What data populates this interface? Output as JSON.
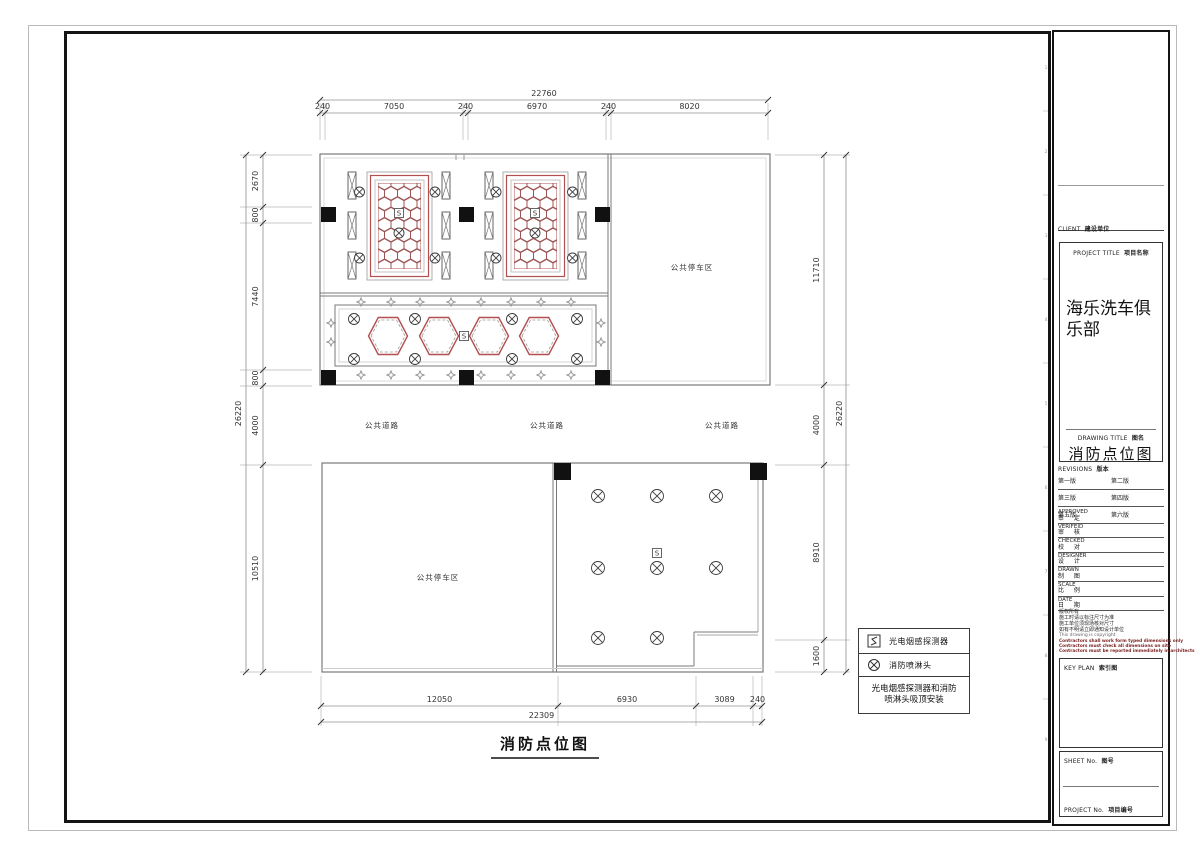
{
  "colors": {
    "wall": "#7a7a7a",
    "red": "#b24f4f",
    "comb": "#9c5454",
    "dimline": "#909090",
    "dimtext": "#333333",
    "ext": "#b8b8b8",
    "column": "#111111",
    "symbol": "#3c3c3c"
  },
  "title_block": {
    "client_label": "CLIENT",
    "client_value": "建设单位",
    "project_title_label": "PROJECT TITLE",
    "project_title_value": "项目名称",
    "project_name": "海乐洗车俱乐部",
    "drawing_title_label": "DRAWING TITLE",
    "drawing_title_value": "图名",
    "drawing_name": "消防点位图",
    "revisions_label": "REVISIONS",
    "revisions_value": "版本",
    "revisions": [
      [
        "第一版",
        "第二版"
      ],
      [
        "第三版",
        "第四版"
      ],
      [
        "第五版",
        "第六版"
      ]
    ],
    "fields": [
      {
        "en": "APPROVED",
        "cn": "审 定"
      },
      {
        "en": "VERIFEID",
        "cn": "审 核"
      },
      {
        "en": "CHECKED",
        "cn": "校 对"
      },
      {
        "en": "DESIGNER",
        "cn": "设 计"
      },
      {
        "en": "DRAWN",
        "cn": "制 图"
      },
      {
        "en": "SCALE",
        "cn": "比 例"
      },
      {
        "en": "DATE",
        "cn": "日 期"
      }
    ],
    "notes_cn": [
      "版权所有",
      "施工时请以标注尺寸为准",
      "施工单位须现场核对尺寸",
      "如有不明请立即通知设计单位"
    ],
    "note_en": "This drawing is copyright",
    "notes_warning": [
      "Contractors shall work form typed dimensions only",
      "Contractors must check all dimensions on site",
      "Contractors must be reported immediately in architects"
    ],
    "key_plan_label": "KEY PLAN",
    "key_plan_value": "索引图",
    "sheet_label": "SHEET No.",
    "sheet_value": "图号",
    "project_no_label": "PROJECT No.",
    "project_no_value": "项目编号",
    "ruler_marks": [
      {
        "y": 69,
        "n": "1"
      },
      {
        "y": 111,
        "n": ""
      },
      {
        "y": 153,
        "n": "2"
      },
      {
        "y": 195,
        "n": ""
      },
      {
        "y": 237,
        "n": "3"
      },
      {
        "y": 279,
        "n": ""
      },
      {
        "y": 321,
        "n": "4"
      },
      {
        "y": 363,
        "n": ""
      },
      {
        "y": 405,
        "n": "5"
      },
      {
        "y": 447,
        "n": ""
      },
      {
        "y": 489,
        "n": "6"
      },
      {
        "y": 531,
        "n": ""
      },
      {
        "y": 573,
        "n": "7"
      },
      {
        "y": 615,
        "n": ""
      },
      {
        "y": 657,
        "n": "8"
      },
      {
        "y": 699,
        "n": ""
      },
      {
        "y": 741,
        "n": "9"
      }
    ]
  },
  "legend": {
    "items": [
      {
        "icon": "smoke-detector-icon",
        "label": "光电烟感探测器"
      },
      {
        "icon": "sprinkler-icon",
        "label": "消防喷淋头"
      }
    ],
    "note": "光电烟感探测器和消防喷淋头吸顶安装"
  },
  "plan": {
    "title": "消防点位图",
    "title_pos": {
      "x": 545,
      "y": 749,
      "ux1": 491,
      "ux2": 599,
      "uy": 758
    },
    "detector_char": "S",
    "area_labels": [
      {
        "text": "公共停车区",
        "x": 692,
        "y": 270
      },
      {
        "text": "公共停车区",
        "x": 438,
        "y": 580
      },
      {
        "text": "公共道路",
        "x": 382,
        "y": 428
      },
      {
        "text": "公共道路",
        "x": 547,
        "y": 428
      },
      {
        "text": "公共道路",
        "x": 722,
        "y": 428
      }
    ],
    "dimensions": {
      "top": {
        "overall": "22760",
        "segments": [
          "240",
          "7050",
          "240",
          "6970",
          "240",
          "8020"
        ],
        "bounds": [
          320,
          325,
          463,
          468,
          606,
          611,
          768
        ],
        "segLine": 113,
        "segLabel": 109,
        "ovLine": 100,
        "ovLabel": 96,
        "ext": [
          103,
          140
        ]
      },
      "bottom": {
        "overall": "22309",
        "segments": [
          "12050",
          "6930",
          "3089",
          "240"
        ],
        "bounds": [
          321,
          558,
          696,
          753,
          762
        ],
        "segLine": 706,
        "segLabel": 702,
        "ovLine": 722,
        "ovLabel": 718,
        "ext": [
          676,
          726
        ]
      },
      "left": {
        "overall": "26220",
        "segments": [
          "2670",
          "800",
          "7440",
          "800",
          "4000",
          "10510"
        ],
        "bounds": [
          155,
          207,
          223,
          370,
          386,
          465,
          672
        ],
        "segLine": 263,
        "segLabel": 258,
        "ovLine": 246,
        "ovLabel": 241,
        "ext": [
          240,
          312
        ]
      },
      "right": {
        "overall": "26220",
        "segments": [
          "11710",
          "4000",
          "8910",
          "1600"
        ],
        "bounds": [
          155,
          385,
          465,
          640,
          672
        ],
        "segLine": 824,
        "segLabel": 819,
        "ovLine": 846,
        "ovLabel": 842,
        "ext": [
          775,
          850
        ]
      }
    },
    "geometry": {
      "rects": [
        {
          "x": 320,
          "y": 154,
          "w": 450,
          "h": 231,
          "c": "#7a7a7a",
          "sw": 1.2
        },
        {
          "x": 324,
          "y": 158,
          "w": 442,
          "h": 223,
          "c": "#d2d2d2",
          "sw": 0.8
        },
        {
          "x": 335,
          "y": 305,
          "w": 261,
          "h": 61,
          "c": "#7a7a7a",
          "sw": 1
        },
        {
          "x": 339,
          "y": 309,
          "w": 253,
          "h": 53,
          "c": "#c8c8c8",
          "sw": 0.8
        },
        {
          "x": 322,
          "y": 463,
          "w": 441,
          "h": 209,
          "c": "#7a7a7a",
          "sw": 1.2
        },
        {
          "x": 367,
          "y": 172,
          "w": 65,
          "h": 108,
          "c": "#9a9a9a",
          "sw": 0.8
        },
        {
          "x": 370.5,
          "y": 175.5,
          "w": 58,
          "h": 101,
          "c": "#b24f4f",
          "sw": 1.2
        },
        {
          "x": 375,
          "y": 180,
          "w": 49,
          "h": 92,
          "c": "#b5b5b5",
          "sw": 0.8
        },
        {
          "x": 503,
          "y": 172,
          "w": 65,
          "h": 108,
          "c": "#9a9a9a",
          "sw": 0.8
        },
        {
          "x": 506.5,
          "y": 175.5,
          "w": 58,
          "h": 101,
          "c": "#b24f4f",
          "sw": 1.2
        },
        {
          "x": 511,
          "y": 180,
          "w": 49,
          "h": 92,
          "c": "#b5b5b5",
          "sw": 0.8
        }
      ],
      "lines": [
        {
          "x1": 608,
          "y1": 154,
          "x2": 608,
          "y2": 385
        },
        {
          "x1": 611,
          "y1": 154,
          "x2": 611,
          "y2": 385
        },
        {
          "x1": 320,
          "y1": 293,
          "x2": 608,
          "y2": 293
        },
        {
          "x1": 320,
          "y1": 296,
          "x2": 608,
          "y2": 296
        },
        {
          "x1": 456,
          "y1": 154,
          "x2": 456,
          "y2": 160,
          "c": "#999999"
        },
        {
          "x1": 464,
          "y1": 154,
          "x2": 464,
          "y2": 160,
          "c": "#999999"
        },
        {
          "x1": 553,
          "y1": 463,
          "x2": 553,
          "y2": 672
        },
        {
          "x1": 556.5,
          "y1": 463,
          "x2": 556.5,
          "y2": 672
        },
        {
          "x1": 758,
          "y1": 463,
          "x2": 758,
          "y2": 632,
          "c": "#aaaaaa"
        },
        {
          "x1": 694,
          "y1": 632,
          "x2": 758,
          "y2": 632
        },
        {
          "x1": 697,
          "y1": 635,
          "x2": 758,
          "y2": 635,
          "c": "#aaaaaa"
        },
        {
          "x1": 694,
          "y1": 632,
          "x2": 694,
          "y2": 666
        },
        {
          "x1": 556,
          "y1": 666,
          "x2": 694,
          "y2": 666
        },
        {
          "x1": 322,
          "y1": 668.5,
          "x2": 763,
          "y2": 668.5,
          "c": "#cccccc"
        }
      ],
      "columns": [
        {
          "x": 321,
          "y": 207,
          "s": 15
        },
        {
          "x": 459,
          "y": 207,
          "s": 15
        },
        {
          "x": 595,
          "y": 207,
          "s": 15
        },
        {
          "x": 321,
          "y": 370,
          "s": 15
        },
        {
          "x": 459,
          "y": 370,
          "s": 15
        },
        {
          "x": 595,
          "y": 370,
          "s": 15
        },
        {
          "x": 554,
          "y": 463,
          "s": 17
        },
        {
          "x": 750,
          "y": 463,
          "s": 17
        }
      ],
      "louvers": {
        "w": 8,
        "h": 27,
        "items": [
          {
            "x": 348,
            "y": 172
          },
          {
            "x": 348,
            "y": 212
          },
          {
            "x": 348,
            "y": 252
          },
          {
            "x": 442,
            "y": 172
          },
          {
            "x": 442,
            "y": 212
          },
          {
            "x": 442,
            "y": 252
          },
          {
            "x": 485,
            "y": 172
          },
          {
            "x": 485,
            "y": 212
          },
          {
            "x": 485,
            "y": 252
          },
          {
            "x": 578,
            "y": 172
          },
          {
            "x": 578,
            "y": 212
          },
          {
            "x": 578,
            "y": 252
          }
        ]
      },
      "honeycombs": {
        "colPitch": 13,
        "rowPitch": 10.4,
        "rx": 6.5,
        "ry": 7.3,
        "items": [
          {
            "x": 378,
            "y": 183,
            "w": 43,
            "h": 86
          },
          {
            "x": 514,
            "y": 183,
            "w": 43,
            "h": 86
          }
        ]
      },
      "big_hexagons": {
        "cy": 336,
        "w": 39,
        "h": 37,
        "cx": [
          388,
          439,
          489,
          539
        ]
      },
      "sprinklers": [
        {
          "x": 359.5,
          "y": 192,
          "r": 5
        },
        {
          "x": 435,
          "y": 192,
          "r": 5
        },
        {
          "x": 496,
          "y": 192,
          "r": 5
        },
        {
          "x": 572.5,
          "y": 192,
          "r": 5
        },
        {
          "x": 359.5,
          "y": 258,
          "r": 5
        },
        {
          "x": 435,
          "y": 258,
          "r": 5
        },
        {
          "x": 496,
          "y": 258,
          "r": 5
        },
        {
          "x": 572.5,
          "y": 258,
          "r": 5
        },
        {
          "x": 399,
          "y": 233,
          "r": 5
        },
        {
          "x": 535,
          "y": 233,
          "r": 5
        },
        {
          "x": 354,
          "y": 319,
          "r": 5.5
        },
        {
          "x": 415,
          "y": 319,
          "r": 5.5
        },
        {
          "x": 512,
          "y": 319,
          "r": 5.5
        },
        {
          "x": 577,
          "y": 319,
          "r": 5.5
        },
        {
          "x": 354,
          "y": 359,
          "r": 5.5
        },
        {
          "x": 415,
          "y": 359,
          "r": 5.5
        },
        {
          "x": 512,
          "y": 359,
          "r": 5.5
        },
        {
          "x": 577,
          "y": 359,
          "r": 5.5
        },
        {
          "x": 598,
          "y": 496,
          "r": 6.5
        },
        {
          "x": 657,
          "y": 496,
          "r": 6.5
        },
        {
          "x": 716,
          "y": 496,
          "r": 6.5
        },
        {
          "x": 598,
          "y": 568,
          "r": 6.5
        },
        {
          "x": 657,
          "y": 568,
          "r": 6.5
        },
        {
          "x": 716,
          "y": 568,
          "r": 6.5
        },
        {
          "x": 598,
          "y": 638,
          "r": 6.5
        },
        {
          "x": 657,
          "y": 638,
          "r": 6.5
        }
      ],
      "detectors": [
        {
          "x": 399,
          "y": 213
        },
        {
          "x": 535,
          "y": 213
        },
        {
          "x": 464,
          "y": 336
        },
        {
          "x": 657,
          "y": 553
        }
      ],
      "diamonds": [
        {
          "x": 361,
          "y": 302
        },
        {
          "x": 391,
          "y": 302
        },
        {
          "x": 420,
          "y": 302
        },
        {
          "x": 451,
          "y": 302
        },
        {
          "x": 481,
          "y": 302
        },
        {
          "x": 511,
          "y": 302
        },
        {
          "x": 541,
          "y": 302
        },
        {
          "x": 571,
          "y": 302
        },
        {
          "x": 361,
          "y": 375
        },
        {
          "x": 391,
          "y": 375
        },
        {
          "x": 420,
          "y": 375
        },
        {
          "x": 451,
          "y": 375
        },
        {
          "x": 481,
          "y": 375
        },
        {
          "x": 511,
          "y": 375
        },
        {
          "x": 541,
          "y": 375
        },
        {
          "x": 571,
          "y": 375
        },
        {
          "x": 331,
          "y": 323
        },
        {
          "x": 331,
          "y": 342
        },
        {
          "x": 601,
          "y": 323
        },
        {
          "x": 601,
          "y": 342
        }
      ]
    }
  }
}
